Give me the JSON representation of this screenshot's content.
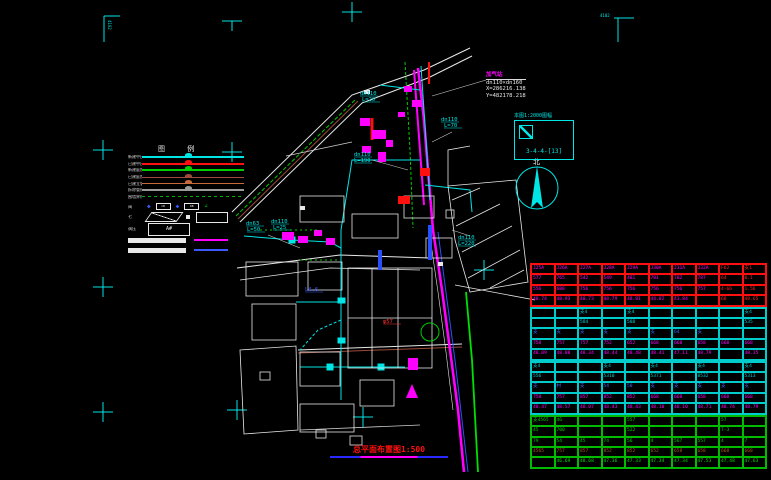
{
  "colors": {
    "cyan": "#00e5e5",
    "magenta": "#ff00ff",
    "green": "#00cc00",
    "red": "#ff1010",
    "blue": "#3a5aff",
    "white": "#e8e8e8",
    "maroon": "#9e4a3a",
    "orange": "#ff8c00",
    "gray": "#9a9a9a"
  },
  "corner_text": "4102",
  "legend": {
    "title": "图 例",
    "line_rows": [
      {
        "label": "新建中压",
        "color": "#00e5e5",
        "thick": 2,
        "dashed": false
      },
      {
        "label": "已建中压",
        "color": "#ff1010",
        "thick": 2,
        "dashed": false
      },
      {
        "label": "新建庭院",
        "color": "#00cc00",
        "thick": 2,
        "dashed": false
      },
      {
        "label": "已建庭院",
        "color": "#9e4a3a",
        "thick": 1,
        "dashed": false
      },
      {
        "label": "已建立管",
        "color": "#c86a3a",
        "thick": 1,
        "dashed": false
      },
      {
        "label": "拆除管线",
        "color": "#9a9a9a",
        "thick": 2,
        "dashed": false
      },
      {
        "label": "围墙界线",
        "color": "#00b000",
        "thick": 1,
        "dashed": true
      }
    ],
    "symbol_row": {
      "label": "阀",
      "diamond": "◆",
      "box1": "CB",
      "box2": "DB",
      "tail": "∠"
    },
    "shape_row": {
      "label": "七"
    },
    "ab_row": {
      "label": "调压",
      "value": "A#"
    },
    "bar_rows": [
      {
        "accent": "#ff00ff"
      },
      {
        "accent": "#3a5aff"
      }
    ]
  },
  "annotation": {
    "name": "加气站",
    "line1": "dn110×dn160",
    "line2": "X=286216.138",
    "line3": "Y=482178.218"
  },
  "detail_box": {
    "title": "本图1:2000图幅",
    "ref": "3-4-4-[13]"
  },
  "north": {
    "label": "北"
  },
  "map_labels": [
    {
      "text": "dn63",
      "x": 246,
      "y": 225,
      "color": "#00e5e5"
    },
    {
      "text": "L=50",
      "x": 247,
      "y": 231,
      "color": "#00e5e5"
    },
    {
      "text": "dn110",
      "x": 271,
      "y": 223,
      "color": "#00e5e5"
    },
    {
      "text": "L=25",
      "x": 273,
      "y": 229,
      "color": "#00e5e5"
    },
    {
      "text": "dn110",
      "x": 354,
      "y": 156,
      "color": "#00e5e5"
    },
    {
      "text": "L=190",
      "x": 354,
      "y": 162,
      "color": "#00e5e5"
    },
    {
      "text": "dn110",
      "x": 360,
      "y": 95,
      "color": "#00e5e5"
    },
    {
      "text": "L=20",
      "x": 362,
      "y": 101,
      "color": "#00e5e5"
    },
    {
      "text": "dn110",
      "x": 441,
      "y": 121,
      "color": "#00e5e5"
    },
    {
      "text": "L=70",
      "x": 444,
      "y": 127,
      "color": "#00e5e5"
    },
    {
      "text": "dn110",
      "x": 458,
      "y": 239,
      "color": "#00e5e5"
    },
    {
      "text": "L=220",
      "x": 458,
      "y": 245,
      "color": "#00e5e5"
    },
    {
      "text": "φ57",
      "x": 383,
      "y": 323,
      "color": "#ff3030"
    },
    {
      "text": "L4.6",
      "x": 305,
      "y": 291,
      "color": "#3a5aff"
    }
  ],
  "table": {
    "sections": [
      {
        "border": "#ff1010",
        "row_colors": [
          "#ff00ff",
          "#ff00ff",
          "#ff00ff",
          "#ff00ff"
        ],
        "red_cols": [
          8,
          9
        ],
        "rows": [
          [
            "J25A",
            "J26A",
            "J27A",
            "J28A",
            "J29A",
            "J30A",
            "J31A",
            "J32A",
            "F62",
            "支1"
          ],
          [
            "577",
            "765",
            "542",
            "549",
            "481",
            "781",
            "782",
            "787",
            "64",
            "0.1"
          ],
          [
            "556",
            "688",
            "756",
            "756",
            "756",
            "756",
            "756",
            "757",
            "4-66",
            "1.56"
          ],
          [
            "48.74",
            "48.93",
            "48.73",
            "48.79",
            "48.81",
            "44.82",
            "43.84",
            "",
            "68",
            "48.65"
          ]
        ]
      },
      {
        "border": "#00cccc",
        "row_colors": [
          "#00cccc",
          "#00cccc",
          "#3a6aff",
          "#ff00ff",
          "#ff00ff"
        ],
        "red_cols": [],
        "rows": [
          [
            "",
            "",
            "支4",
            "",
            "支4",
            "",
            "",
            "",
            "",
            "支4"
          ],
          [
            "",
            "",
            "584",
            "",
            "588",
            "",
            "",
            "",
            "",
            "535"
          ],
          [
            "支",
            "支",
            "支",
            "支",
            "支",
            "支",
            "64",
            "支",
            "",
            ""
          ],
          [
            "758",
            "757",
            "757",
            "752",
            "652",
            "668",
            "668",
            "658",
            "668",
            "668"
          ],
          [
            "48.09",
            "48.08",
            "48.34",
            "48.44",
            "48.48",
            "48.41",
            "47.11",
            "48.79",
            "",
            "48.35"
          ]
        ]
      },
      {
        "border": "#00cccc",
        "row_colors": [
          "#00cccc",
          "#00cccc",
          "#3a6aff",
          "#ff00ff",
          "#ff00ff"
        ],
        "red_cols": [],
        "rows": [
          [
            "支4",
            "",
            "",
            "支4",
            "",
            "支4",
            "",
            "支4",
            "",
            "支4"
          ],
          [
            "556",
            "",
            "",
            "5310",
            "",
            "5371",
            "",
            "8532",
            "",
            "5313"
          ],
          [
            "支",
            "村",
            "支",
            "54",
            "50",
            "支",
            "支",
            "支",
            "支",
            "支"
          ],
          [
            "758",
            "757",
            "857",
            "852",
            "852",
            "668",
            "668",
            "658",
            "668",
            "668"
          ],
          [
            "48.47",
            "48.57",
            "48.07",
            "48.43",
            "48.43",
            "48.10",
            "48.10",
            "48.71",
            "48.74",
            "48.79"
          ]
        ]
      },
      {
        "border": "#00bb00",
        "row_colors": [
          "#00d000",
          "#00d000",
          "#00d000",
          "#b05820",
          "#00e000"
        ],
        "red_cols": [],
        "rows": [
          [
            "支4565",
            "46",
            "",
            "",
            "557",
            "",
            "",
            "",
            "57",
            ""
          ],
          [
            "45",
            "700",
            "",
            "",
            "522",
            "",
            "",
            "",
            "7-3",
            ""
          ],
          [
            "79",
            "54",
            "45",
            "74",
            "56",
            "4",
            "567",
            "557",
            "4",
            "7"
          ],
          [
            "4565",
            "757",
            "857",
            "852",
            "852",
            "652",
            "658",
            "658",
            "668",
            "668"
          ],
          [
            "",
            "46.69",
            "48.68",
            "47.36",
            "47.33",
            "47.34",
            "47.34",
            "47.53",
            "47.48",
            "47.63"
          ]
        ]
      }
    ]
  },
  "title": {
    "text": "总平面布置图1:500"
  }
}
